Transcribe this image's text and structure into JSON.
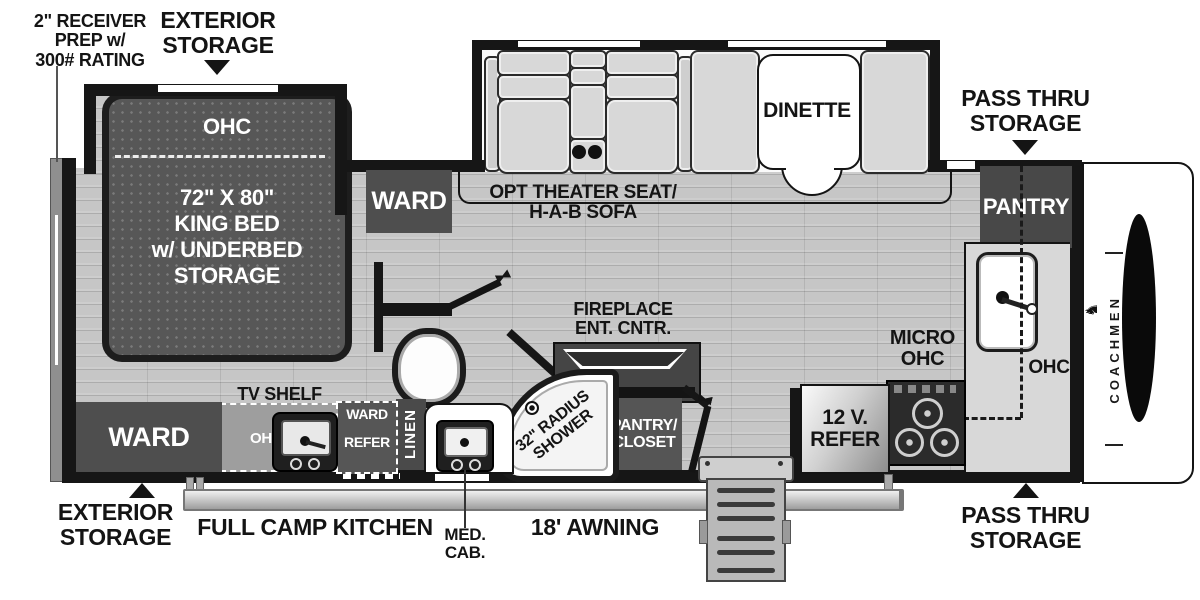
{
  "callouts": {
    "receiver_prep": "2\" RECEIVER\nPREP w/\n300# RATING",
    "exterior_storage_top": "EXTERIOR\nSTORAGE",
    "pass_thru_storage_top": "PASS THRU\nSTORAGE",
    "exterior_storage_bottom": "EXTERIOR\nSTORAGE",
    "pass_thru_storage_bottom": "PASS THRU\nSTORAGE",
    "full_camp_kitchen": "FULL CAMP KITCHEN",
    "med_cab": "MED.\nCAB.",
    "awning": "18' AWNING"
  },
  "bedroom": {
    "ohc": "OHC",
    "bed": "72\" X 80\"\nKING BED\nw/ UNDERBED\nSTORAGE",
    "ward_top": "WARD",
    "ward_bottom": "WARD",
    "tv_shelf": "TV SHELF"
  },
  "living": {
    "theater_seat": "OPT THEATER SEAT/\nH-A-B SOFA",
    "dinette": "DINETTE",
    "fireplace": "FIREPLACE\nENT. CNTR."
  },
  "kitchen": {
    "pantry": "PANTRY",
    "ohc": "OHC",
    "micro_ohc": "MICRO\nOHC",
    "refer": "12 V.\nREFER",
    "camp_oh": "OH",
    "ward_small": "WARD",
    "refer_small": "REFER"
  },
  "bath": {
    "shower": "32\" RADIUS\nSHOWER",
    "pantry_closet": "PANTRY/\nCLOSET",
    "linen": "LINEN"
  },
  "brand": {
    "name": "COACHMEN",
    "crest_glyph": "♞"
  },
  "colors": {
    "wall": "#161616",
    "floor": "#c6c6c6",
    "cabinet": "#4e4e4e",
    "label": "#141414"
  }
}
